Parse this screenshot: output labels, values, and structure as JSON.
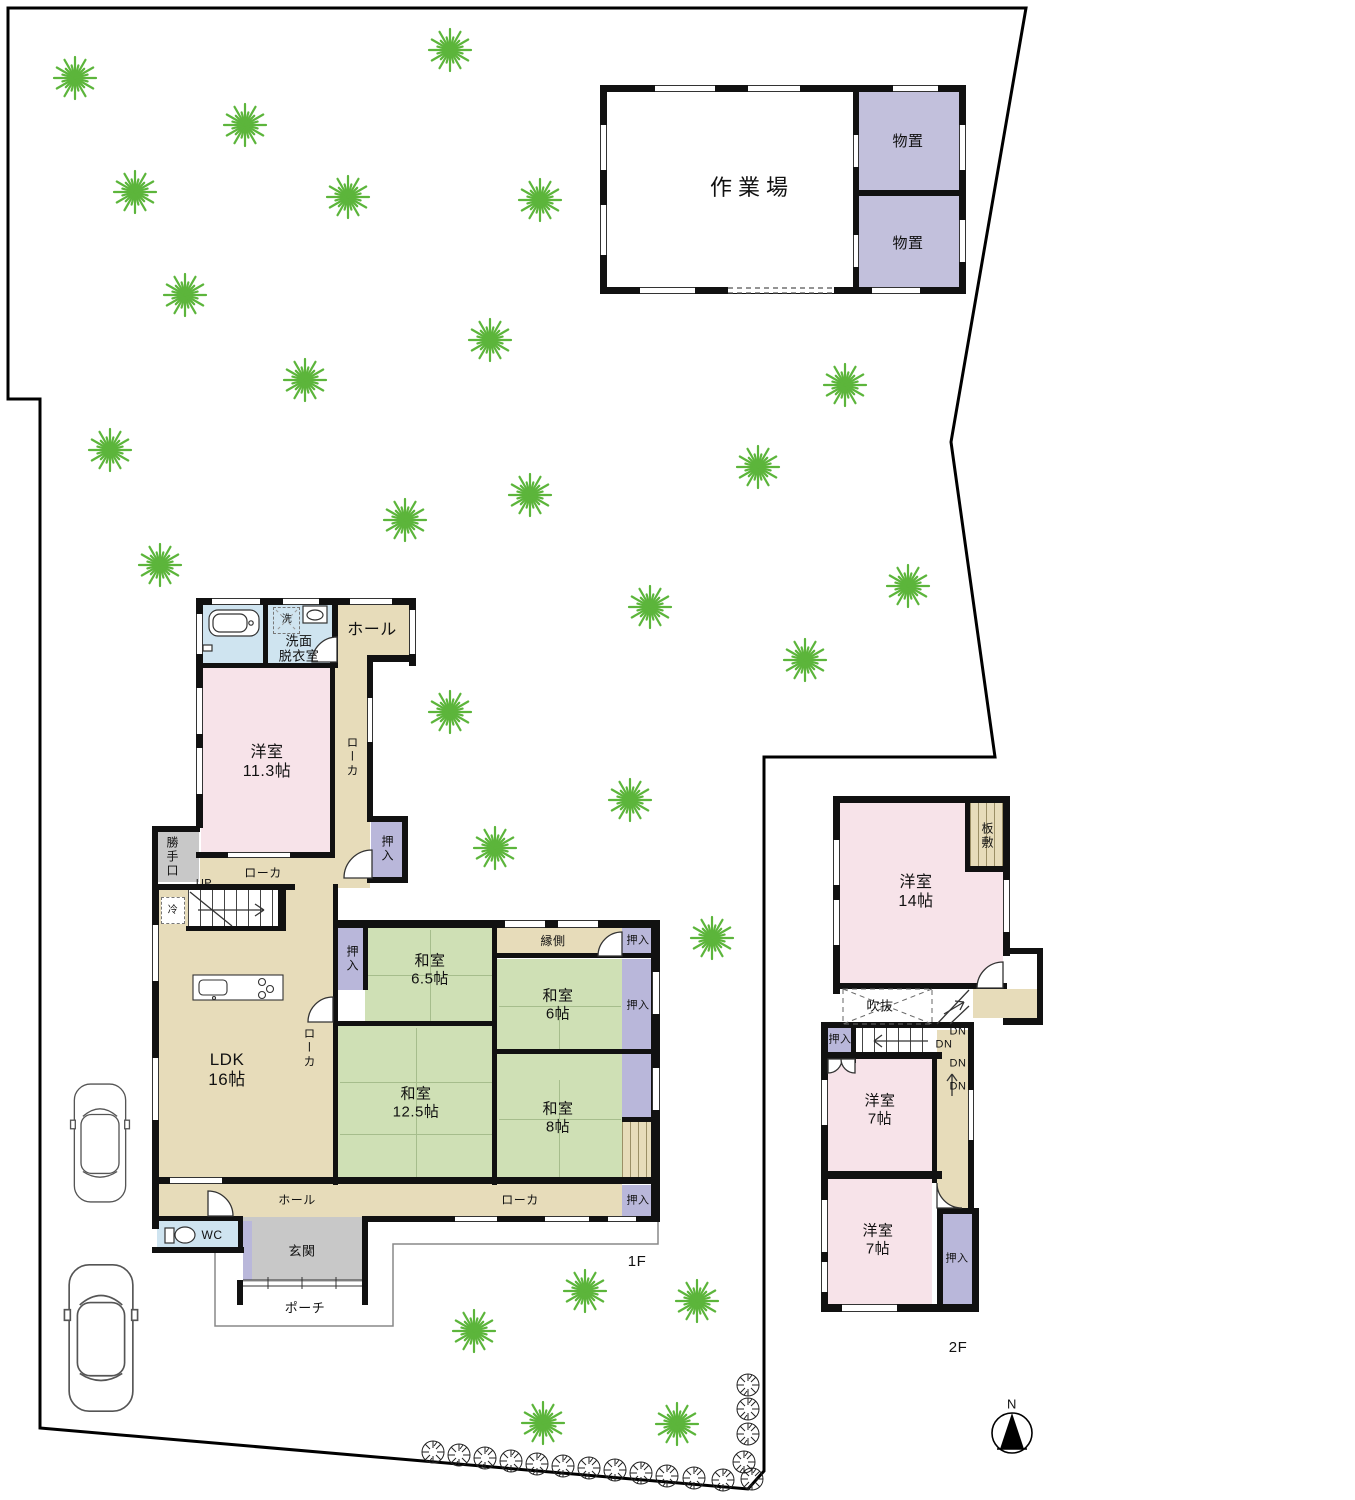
{
  "site": {
    "floor1_label": "1F",
    "floor2_label": "2F",
    "compass_north": "N",
    "tree_color": "#5cb53b",
    "trees": [
      [
        75,
        78
      ],
      [
        245,
        125
      ],
      [
        450,
        50
      ],
      [
        135,
        192
      ],
      [
        348,
        197
      ],
      [
        540,
        200
      ],
      [
        185,
        295
      ],
      [
        490,
        340
      ],
      [
        305,
        380
      ],
      [
        845,
        385
      ],
      [
        110,
        450
      ],
      [
        758,
        467
      ],
      [
        530,
        495
      ],
      [
        405,
        520
      ],
      [
        160,
        565
      ],
      [
        908,
        586
      ],
      [
        650,
        607
      ],
      [
        805,
        660
      ],
      [
        450,
        712
      ],
      [
        630,
        800
      ],
      [
        495,
        848
      ],
      [
        712,
        938
      ],
      [
        585,
        1291
      ],
      [
        697,
        1301
      ],
      [
        474,
        1331
      ],
      [
        543,
        1423
      ],
      [
        677,
        1424
      ]
    ],
    "shrubs": [
      [
        433,
        1452
      ],
      [
        459,
        1455
      ],
      [
        485,
        1458
      ],
      [
        511,
        1461
      ],
      [
        537,
        1464
      ],
      [
        563,
        1466
      ],
      [
        589,
        1468
      ],
      [
        615,
        1470
      ],
      [
        641,
        1473
      ],
      [
        667,
        1476
      ],
      [
        694,
        1478
      ],
      [
        723,
        1480
      ],
      [
        748,
        1385
      ],
      [
        748,
        1409
      ],
      [
        748,
        1434
      ],
      [
        744,
        1462
      ],
      [
        752,
        1479
      ]
    ]
  },
  "workshop": {
    "label": "作業場",
    "storage_top": "物置",
    "storage_bottom": "物置"
  },
  "f1": {
    "hall_top": "ホール",
    "senmen": "洗面\n脱衣室",
    "laundry": "洗",
    "yoshitsu113": "洋室\n11.3帖",
    "rouka": "ローカ",
    "katteguchi": "勝手口",
    "oshiire": "押入",
    "up": "UP",
    "fridge": "冷",
    "ldk": "LDK\n16帖",
    "washitsu65": "和室\n6.5帖",
    "engawa": "縁側",
    "washitsu6": "和室\n6帖",
    "washitsu125": "和室\n12.5帖",
    "washitsu8": "和室\n8帖",
    "hall_bottom": "ホール",
    "wc": "WC",
    "genkan": "玄関",
    "porch": "ポーチ"
  },
  "f2": {
    "yoshitsu14": "洋室\n14帖",
    "itajiki": "板敷",
    "fukinuke": "吹抜",
    "oshiire": "押入",
    "dn": "DN",
    "yoshitsu7a": "洋室\n7帖",
    "yoshitsu7b": "洋室\n7帖"
  },
  "colors": {
    "pink_room": "#f7e3e9",
    "tatami_room": "#cfe0b5",
    "corridor_tan": "#e7dcba",
    "closet_purple": "#b9b7da",
    "storage_purple": "#c2c0dc",
    "wet_blue": "#cfe4f0",
    "genkan_gray": "#c8c8c8"
  }
}
